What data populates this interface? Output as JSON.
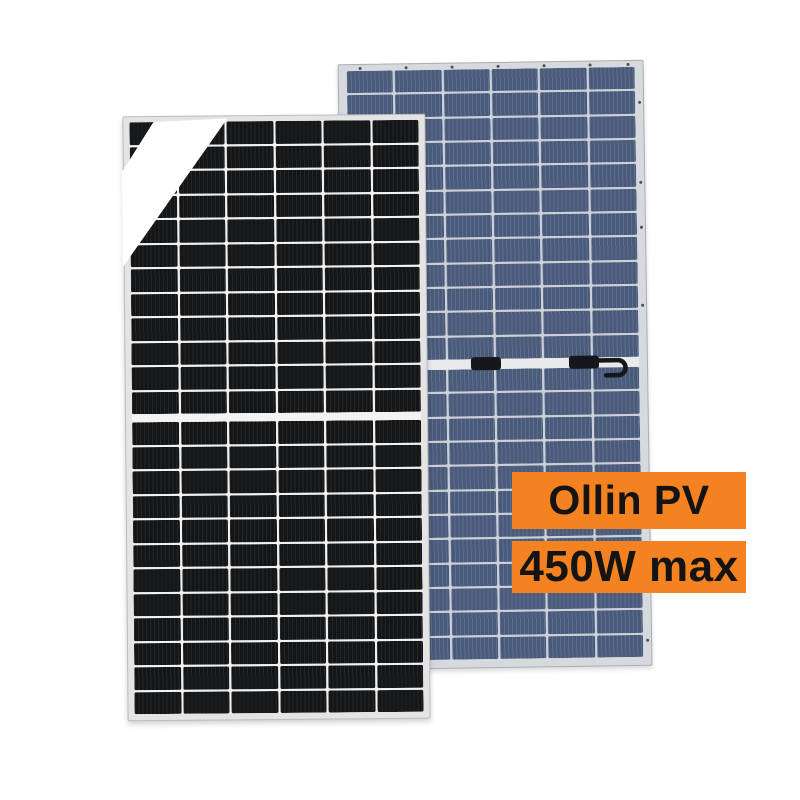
{
  "page": {
    "background_color": "#ffffff"
  },
  "product": {
    "brand_label": "Ollin PV",
    "power_label": "450W max",
    "label_background_color": "#F58220",
    "label_text_color": "#141414"
  },
  "panels": {
    "front": {
      "description": "black monocrystalline half-cut solar panel with white glare stripe on top-left corner",
      "cols": 6,
      "rows_per_half": 12,
      "cell_color": "#141517",
      "line_color": "rgba(255,255,255,0.07)",
      "gap_color": "#f1f1f1",
      "frame_color": "#e4e4e5",
      "frame_edge_color": "#bcbcbd",
      "divider_color": "#f3f3f4"
    },
    "back": {
      "description": "blue polycrystalline half-cut solar panel with two junction connectors and cable loop on middle strip",
      "cols": 6,
      "rows_per_half": 12,
      "cell_color": "#495a7a",
      "line_color": "rgba(255,255,255,0.12)",
      "gap_color": "#ccd1d8",
      "frame_color": "#d6d9dd",
      "frame_edge_color": "#aaaeb4",
      "divider_color": "#e8eaec",
      "connector_color": "#16171b"
    }
  }
}
